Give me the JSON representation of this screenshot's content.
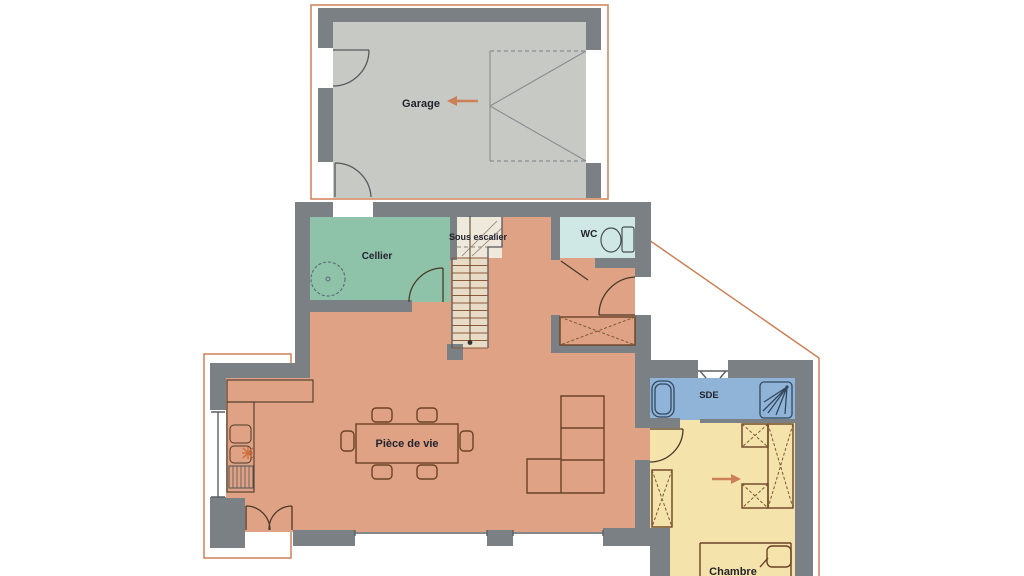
{
  "floorplan": {
    "rooms": {
      "garage": {
        "label": "Garage"
      },
      "cellier": {
        "label": "Cellier"
      },
      "sous_escalier": {
        "label": "Sous escalier"
      },
      "wc": {
        "label": "WC"
      },
      "piece_de_vie": {
        "label": "Pièce de vie"
      },
      "sde": {
        "label": "SDE"
      },
      "chambre": {
        "label": "Chambre"
      }
    },
    "colors": {
      "wall": "#7b8084",
      "garage_floor": "#c7c9c5",
      "living_floor": "#dfa285",
      "cellier_floor": "#8ec2a9",
      "wc_floor": "#cfe8e6",
      "sde_floor": "#8fb4d8",
      "chambre_floor": "#f4e3ab",
      "stair_landing": "#efe9dc",
      "stair_flight": "#e9dcc6",
      "boundary_accent": "#cd8055"
    }
  }
}
